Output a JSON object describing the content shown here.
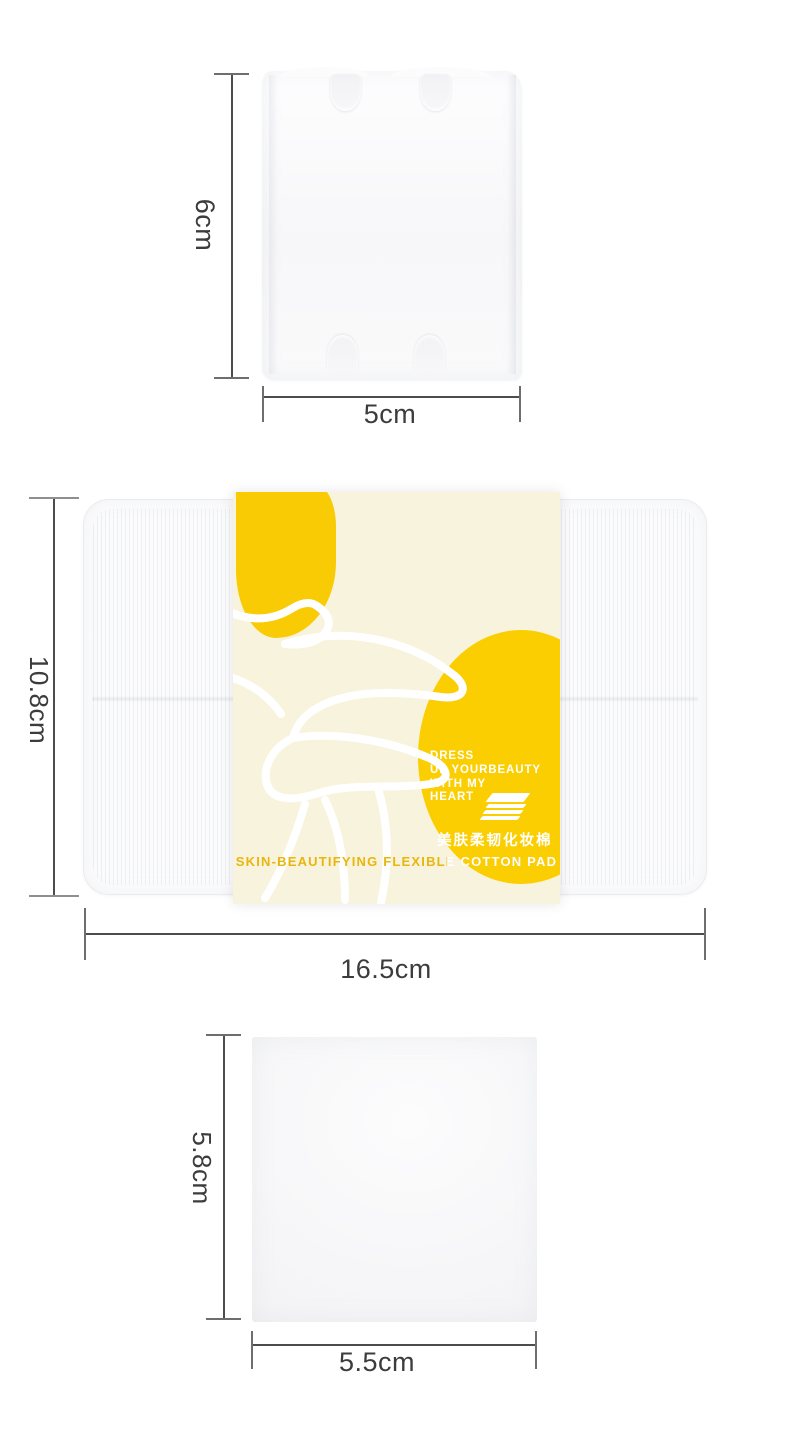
{
  "colors": {
    "background": "#ffffff",
    "band_cream": "#F8F3DC",
    "blob_yellow": "#F8CB04",
    "oval_yellow": "#FBCE02",
    "gold_text": "#E8B60E",
    "dimension_line": "#4c4c4c",
    "dimension_text": "#3c3c3c"
  },
  "icons": {
    "pad_stack": "pad-stack-icon",
    "flower": "flower-line-art"
  },
  "diagram": {
    "top_pad": {
      "height_label": "6cm",
      "width_label": "5cm"
    },
    "package": {
      "height_label": "10.8cm",
      "width_label": "16.5cm",
      "band": {
        "slogan": [
          "DRESS",
          "UP YOURBEAUTY",
          "WITH MY",
          "HEART"
        ],
        "name_zh": "美肤柔韧化妆棉",
        "name_en": "SKIN-BEAUTIFYING FLEXIBLE COTTON PAD"
      }
    },
    "bottom_pad": {
      "height_label": "5.8cm",
      "width_label": "5.5cm"
    }
  }
}
